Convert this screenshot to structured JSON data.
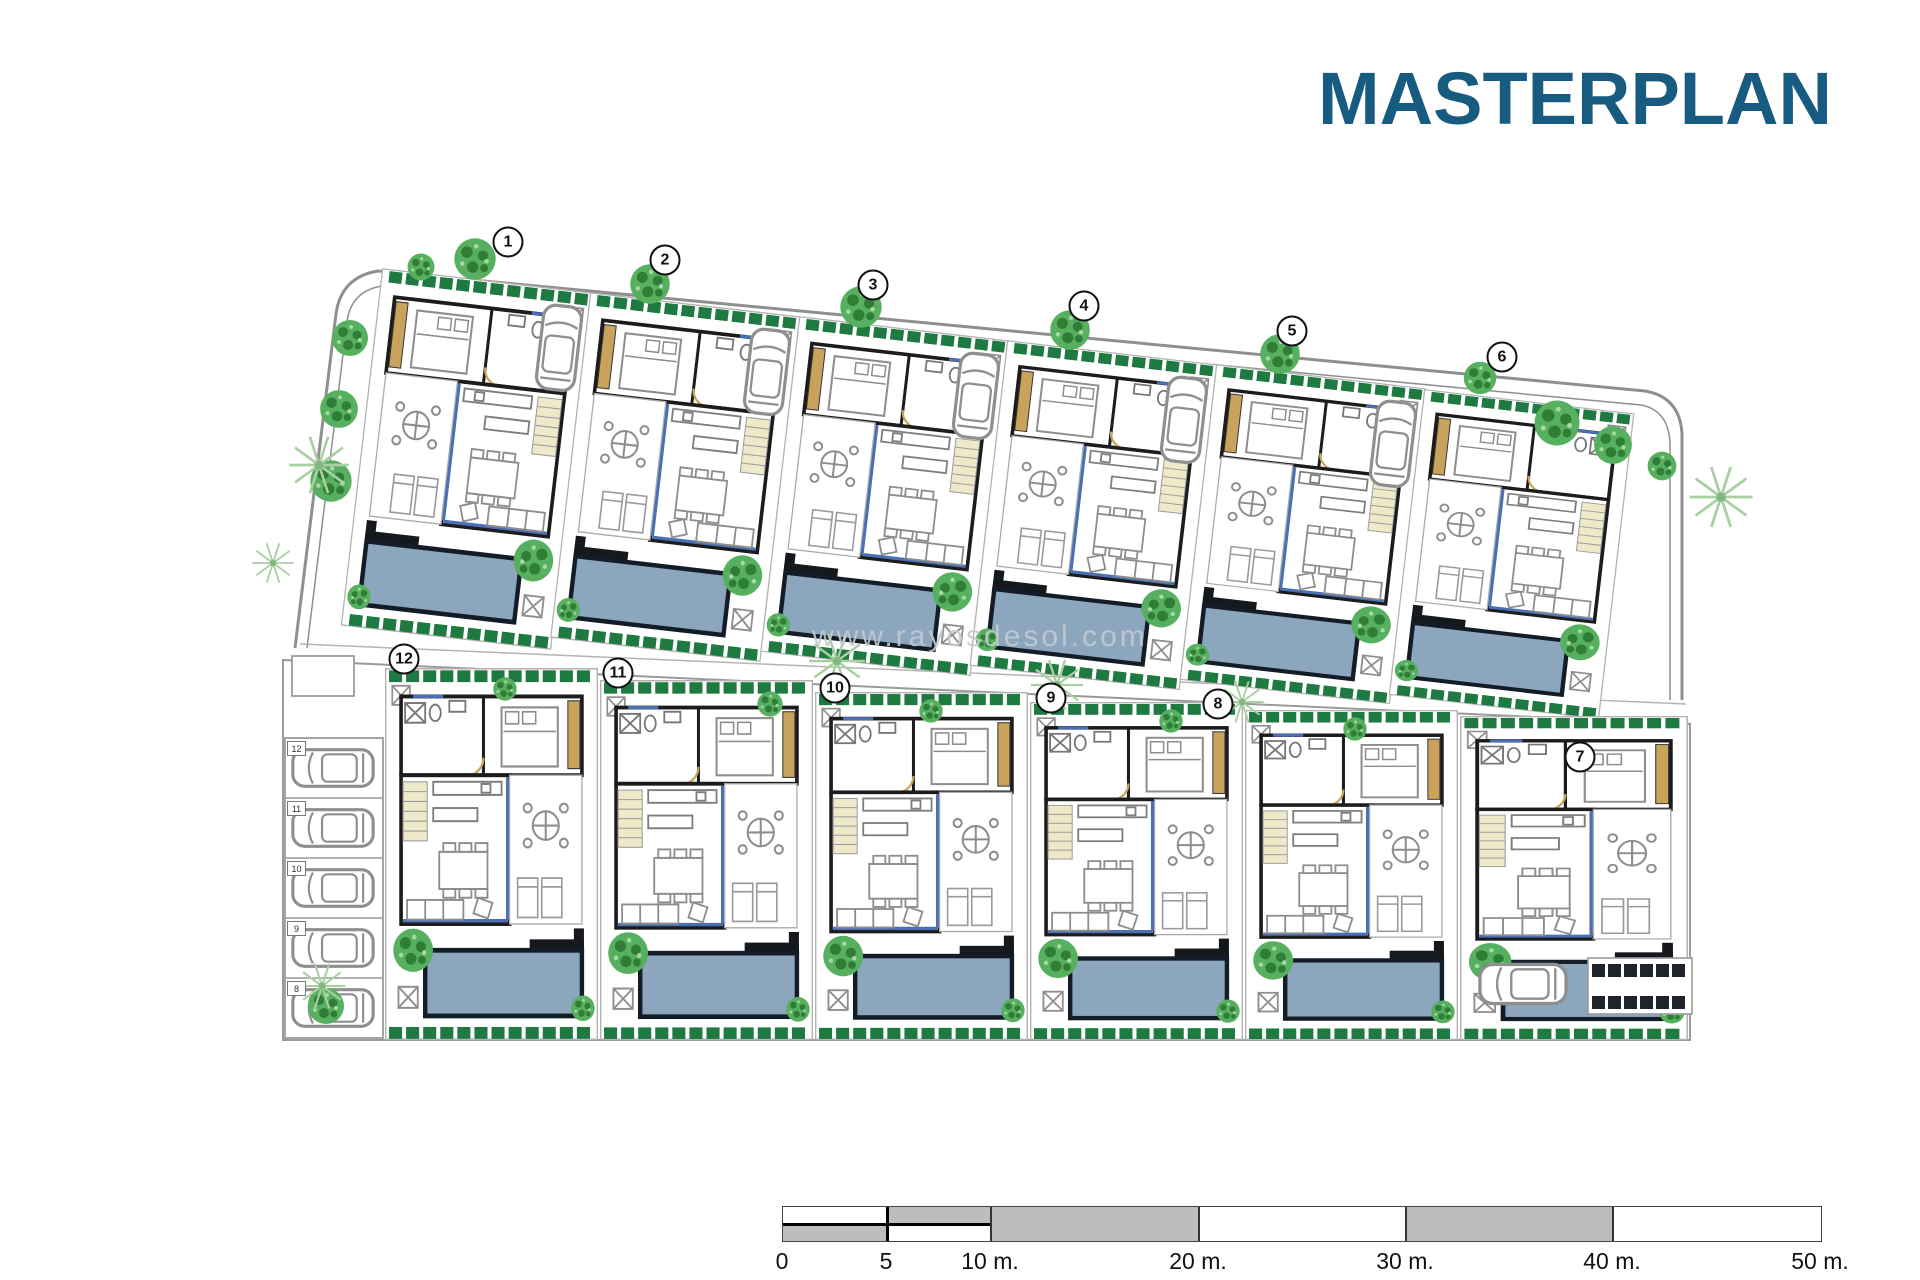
{
  "header": {
    "title": "MASTERPLAN",
    "title_color": "#175b80"
  },
  "watermark": {
    "text": "www.rayosdesol.com"
  },
  "plots": [
    {
      "number": "1"
    },
    {
      "number": "2"
    },
    {
      "number": "3"
    },
    {
      "number": "4"
    },
    {
      "number": "5"
    },
    {
      "number": "6"
    },
    {
      "number": "7"
    },
    {
      "number": "8"
    },
    {
      "number": "9"
    },
    {
      "number": "10"
    },
    {
      "number": "11"
    },
    {
      "number": "12"
    }
  ],
  "carport": {
    "bays": [
      {
        "label": "12"
      },
      {
        "label": "11"
      },
      {
        "label": "10"
      },
      {
        "label": "9"
      },
      {
        "label": "8"
      }
    ]
  },
  "scalebar": {
    "labels": [
      "0",
      "5",
      "10 m.",
      "20 m.",
      "30 m.",
      "40 m.",
      "50 m."
    ]
  },
  "legend_colors": {
    "pool": "#8ba6bd",
    "pool_border": "#131c27",
    "tree": "#56b05f",
    "tree_dark": "#2f7d36",
    "hedge": "#1e7a40",
    "palm": "#a9cfa2",
    "wood_tan": "#c9a35c",
    "glass_blue": "#4a6fb5",
    "wall": "#1c1c1c",
    "street_gray": "#8f8f8f",
    "scalebar_gray": "#bdbdbd"
  }
}
